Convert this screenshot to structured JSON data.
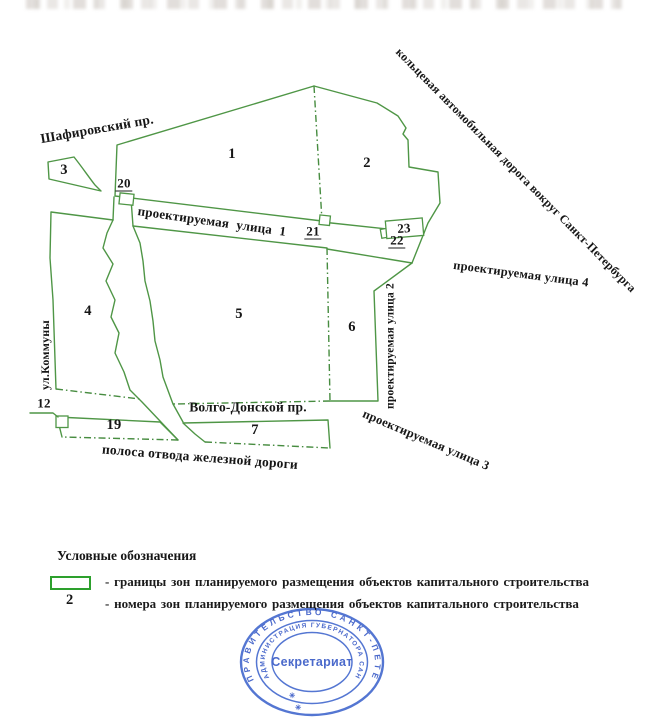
{
  "colors": {
    "map_line_green": "#4f9646",
    "legend_swatch_green": "#2da02d",
    "stamp_blue": "#3c63cc",
    "text": "#161616"
  },
  "map": {
    "zone_numbers": {
      "z1": "1",
      "z2": "2",
      "z3": "3",
      "z4": "4",
      "z5": "5",
      "z6": "6",
      "z7": "7",
      "z19": "19"
    },
    "markers": {
      "m12": "12",
      "m20": "20",
      "m21": "21",
      "m22": "22",
      "m23": "23"
    },
    "streets": {
      "shafirovsky": "Шафировский пр.",
      "street1": "проектируемая улица 1",
      "street2": "проектируемая улица 2",
      "street3": "проектируемая улица 3",
      "street4": "проектируемая улица 4",
      "ring_road": "кольцевая автомобильная дорога вокруг Санкт-Петербурга",
      "volgo_donskoy": "Волго-Донской пр.",
      "railway_strip": "полоса отвода железной дороги",
      "kommuny": "ул.Коммуны"
    }
  },
  "legend": {
    "title": "Условные обозначения",
    "items": [
      {
        "symbol": "zone-boundary-swatch",
        "text": "- границы зон  планируемого размещения объектов капитального строительства"
      },
      {
        "symbol": "2",
        "text": "- номера зон  планируемого размещения объектов капитального строительства"
      }
    ]
  },
  "stamp": {
    "outer_text": "ПРАВИТЕЛЬСТВО САНКТ-ПЕТЕРБУРГА",
    "inner_text": "АДМИНИСТРАЦИЯ ГУБЕРНАТОРА САНКТ-ПЕТЕРБУРГА",
    "center_text": "Секретариат",
    "separator_mark": "✳"
  }
}
